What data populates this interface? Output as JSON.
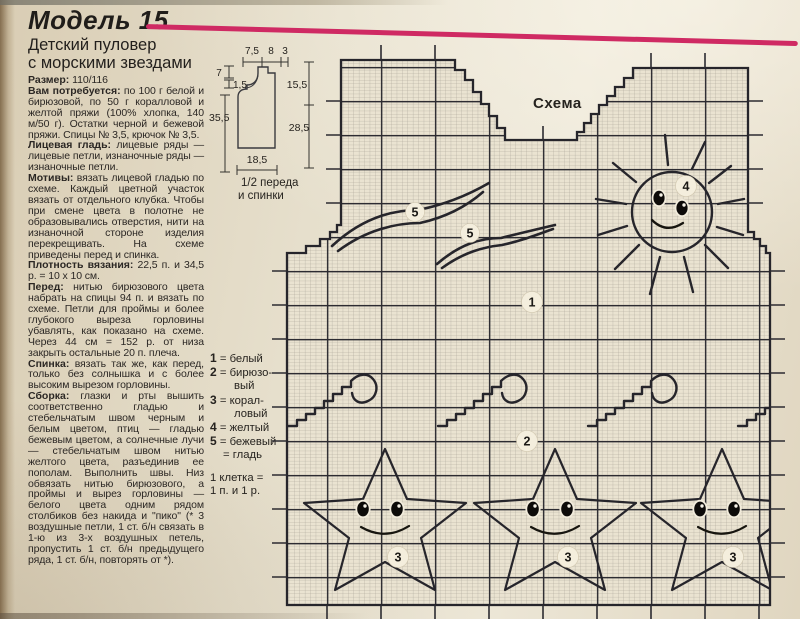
{
  "page": {
    "title": "Модель 15",
    "subtitle_lines": [
      "Детский пуловер",
      "с морскими звездами"
    ]
  },
  "colors": {
    "accent_pink": "#cf2a63",
    "paper": "#e8e1cf",
    "ink": "#2b2826",
    "grid_fine": "#a7a196",
    "grid_bold": "#2c2b31"
  },
  "article": {
    "paragraphs": [
      {
        "lead": "Размер:",
        "text": "110/116"
      },
      {
        "lead": "Вам потребуется:",
        "text": "по 100 г белой и бирюзовой, по 50 г коралловой и желтой пряжи (100% хлопка, 140 м/50 г). Остатки черной и бежевой пряжи. Спицы № 3,5, крючок № 3,5."
      },
      {
        "lead": "Лицевая гладь:",
        "text": "лицевые ряды — лицевые петли, изнаночные ряды — изнаночные петли."
      },
      {
        "lead": "Мотивы:",
        "text": "вязать лицевой гладью по схеме. Каждый цветной участок вязать от отдельного клубка. Чтобы при смене цвета в полотне не образовывались отверстия, нити на изнаночной стороне изделия перекрещивать. На схеме приведены перед и спинка."
      },
      {
        "lead": "Плотность вязания:",
        "text": "22,5 п. и 34,5 р. = 10 x 10 см."
      },
      {
        "lead": "Перед:",
        "text": "нитью бирюзового цвета набрать на спицы 94 п. и вязать по схеме. Петли для проймы и более глубокого выреза горловины убавлять, как показано на схеме. Через 44 см = 152 р. от низа закрыть остальные 20 п. плеча."
      },
      {
        "lead": "Спинка:",
        "text": "вязать так же, как перед, только без солнышка и с более высоким вырезом горловины."
      },
      {
        "lead": "Сборка:",
        "text": "глазки и рты вышить соответственно гладью и стебельчатым швом черным и белым цветом, птиц — гладью бежевым цветом, а солнечные лучи — стебельчатым швом нитью желтого цвета, разъединив ее пополам. Выполнить швы. Низ обвязать нитью бирюзового, а проймы и вырез горловины — белого цвета одним рядом столбиков без накида и \"пико\" (* 3 воздушные петли, 1 ст. б/н связать в 1-ю из 3-х воздушных петель, пропустить 1 ст. б/н предыдущего ряда, 1 ст. б/н, повторять от *)."
      }
    ]
  },
  "legend": {
    "rows": [
      {
        "num": "1",
        "text": "= белый"
      },
      {
        "num": "2",
        "text": "= бирюзо-",
        "cont": "вый"
      },
      {
        "num": "3",
        "text": "= корал-",
        "cont": "ловый"
      },
      {
        "num": "4",
        "text": "= желтый"
      },
      {
        "num": "5",
        "text": "= бежевый"
      },
      {
        "num": "",
        "text": "= гладь"
      }
    ],
    "note_lines": [
      "1 клетка =",
      "1 п. и 1 р."
    ]
  },
  "schematic": {
    "caption_lines": [
      "1/2 переда",
      "и спинки"
    ],
    "dims": {
      "top1": "7,5",
      "top2": "8",
      "top3": "3",
      "left_neck": "7",
      "left_back": "1,5",
      "left_len": "35,5",
      "right_arm": "15,5",
      "right_side": "28,5",
      "bottom_w": "18,5"
    }
  },
  "chart": {
    "label": "Схема",
    "badges": {
      "front": "1",
      "waves": "2",
      "starfish": "3",
      "sun": "4",
      "bird": "5"
    }
  }
}
